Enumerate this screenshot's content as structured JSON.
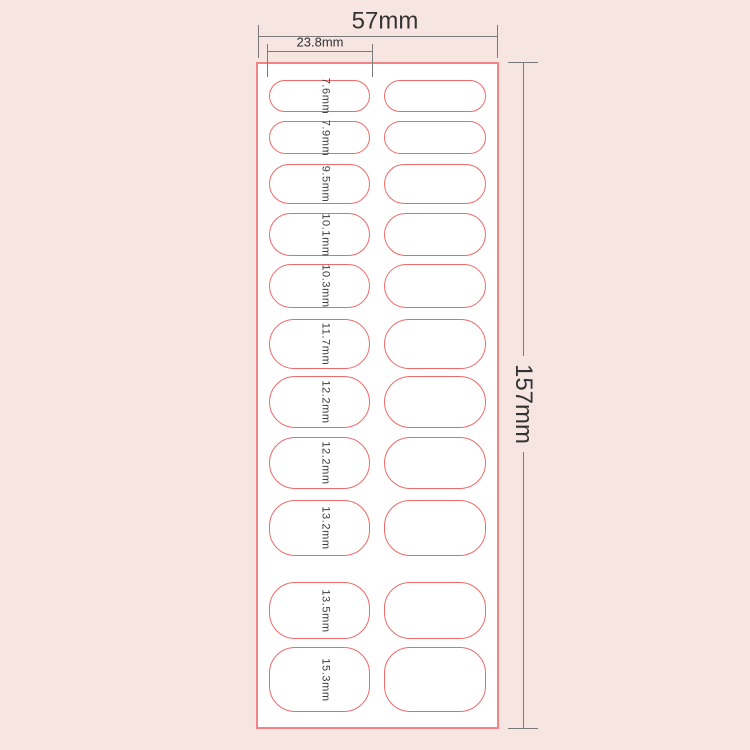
{
  "colors": {
    "background": "#f6e5e1",
    "sheet_fill": "#ffffff",
    "sheet_border": "#f18585",
    "sticker_outline": "#ee6a6a",
    "dimension_line": "#7a7a7a",
    "dimension_text": "#333333"
  },
  "sheet": {
    "width_label": "57mm",
    "height_label": "157mm",
    "column_width_label": "23.8mm",
    "columns": 2,
    "rows": [
      {
        "size_label": "7.6mm"
      },
      {
        "size_label": "7.9mm"
      },
      {
        "size_label": "9.5mm"
      },
      {
        "size_label": "10.1mm"
      },
      {
        "size_label": "10.3mm"
      },
      {
        "size_label": "11.7mm"
      },
      {
        "size_label": "12.2mm"
      },
      {
        "size_label": "12.2mm"
      },
      {
        "size_label": "13.2mm"
      },
      {
        "size_label": "13.5mm"
      },
      {
        "size_label": "15.3mm"
      }
    ]
  }
}
